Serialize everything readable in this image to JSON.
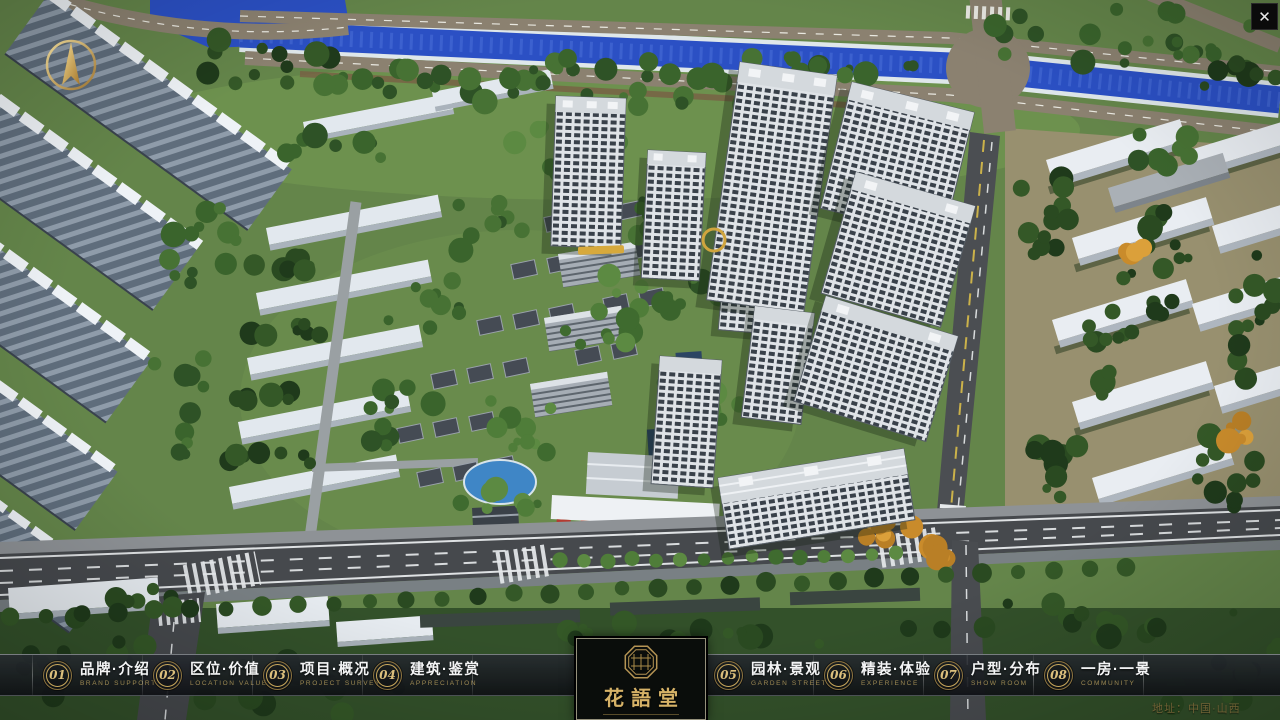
{
  "ui": {
    "close_icon": "✕"
  },
  "menu": {
    "items": [
      {
        "number": "01",
        "label": "品牌·介绍",
        "caption": "BRAND SUPPORT"
      },
      {
        "number": "02",
        "label": "区位·价值",
        "caption": "LOCATION VALUE"
      },
      {
        "number": "03",
        "label": "项目·概况",
        "caption": "PROJECT SURVEY"
      },
      {
        "number": "04",
        "label": "建筑·鉴赏",
        "caption": "APPRECIATION"
      },
      {
        "number": "05",
        "label": "园林·景观",
        "caption": "GARDEN STREET"
      },
      {
        "number": "06",
        "label": "精装·体验",
        "caption": "EXPERIENCE"
      },
      {
        "number": "07",
        "label": "户型·分布",
        "caption": "SHOW ROOM"
      },
      {
        "number": "08",
        "label": "一房·一景",
        "caption": "COMMUNITY"
      }
    ]
  },
  "brand": {
    "name": "花語堂"
  },
  "footer": {
    "address": "地址：中国·山西"
  },
  "colors": {
    "gold": "#c9a85c",
    "bar_bg": "#1a1d22",
    "river": "#2b50c4",
    "roof_white": "#e9edf2"
  }
}
